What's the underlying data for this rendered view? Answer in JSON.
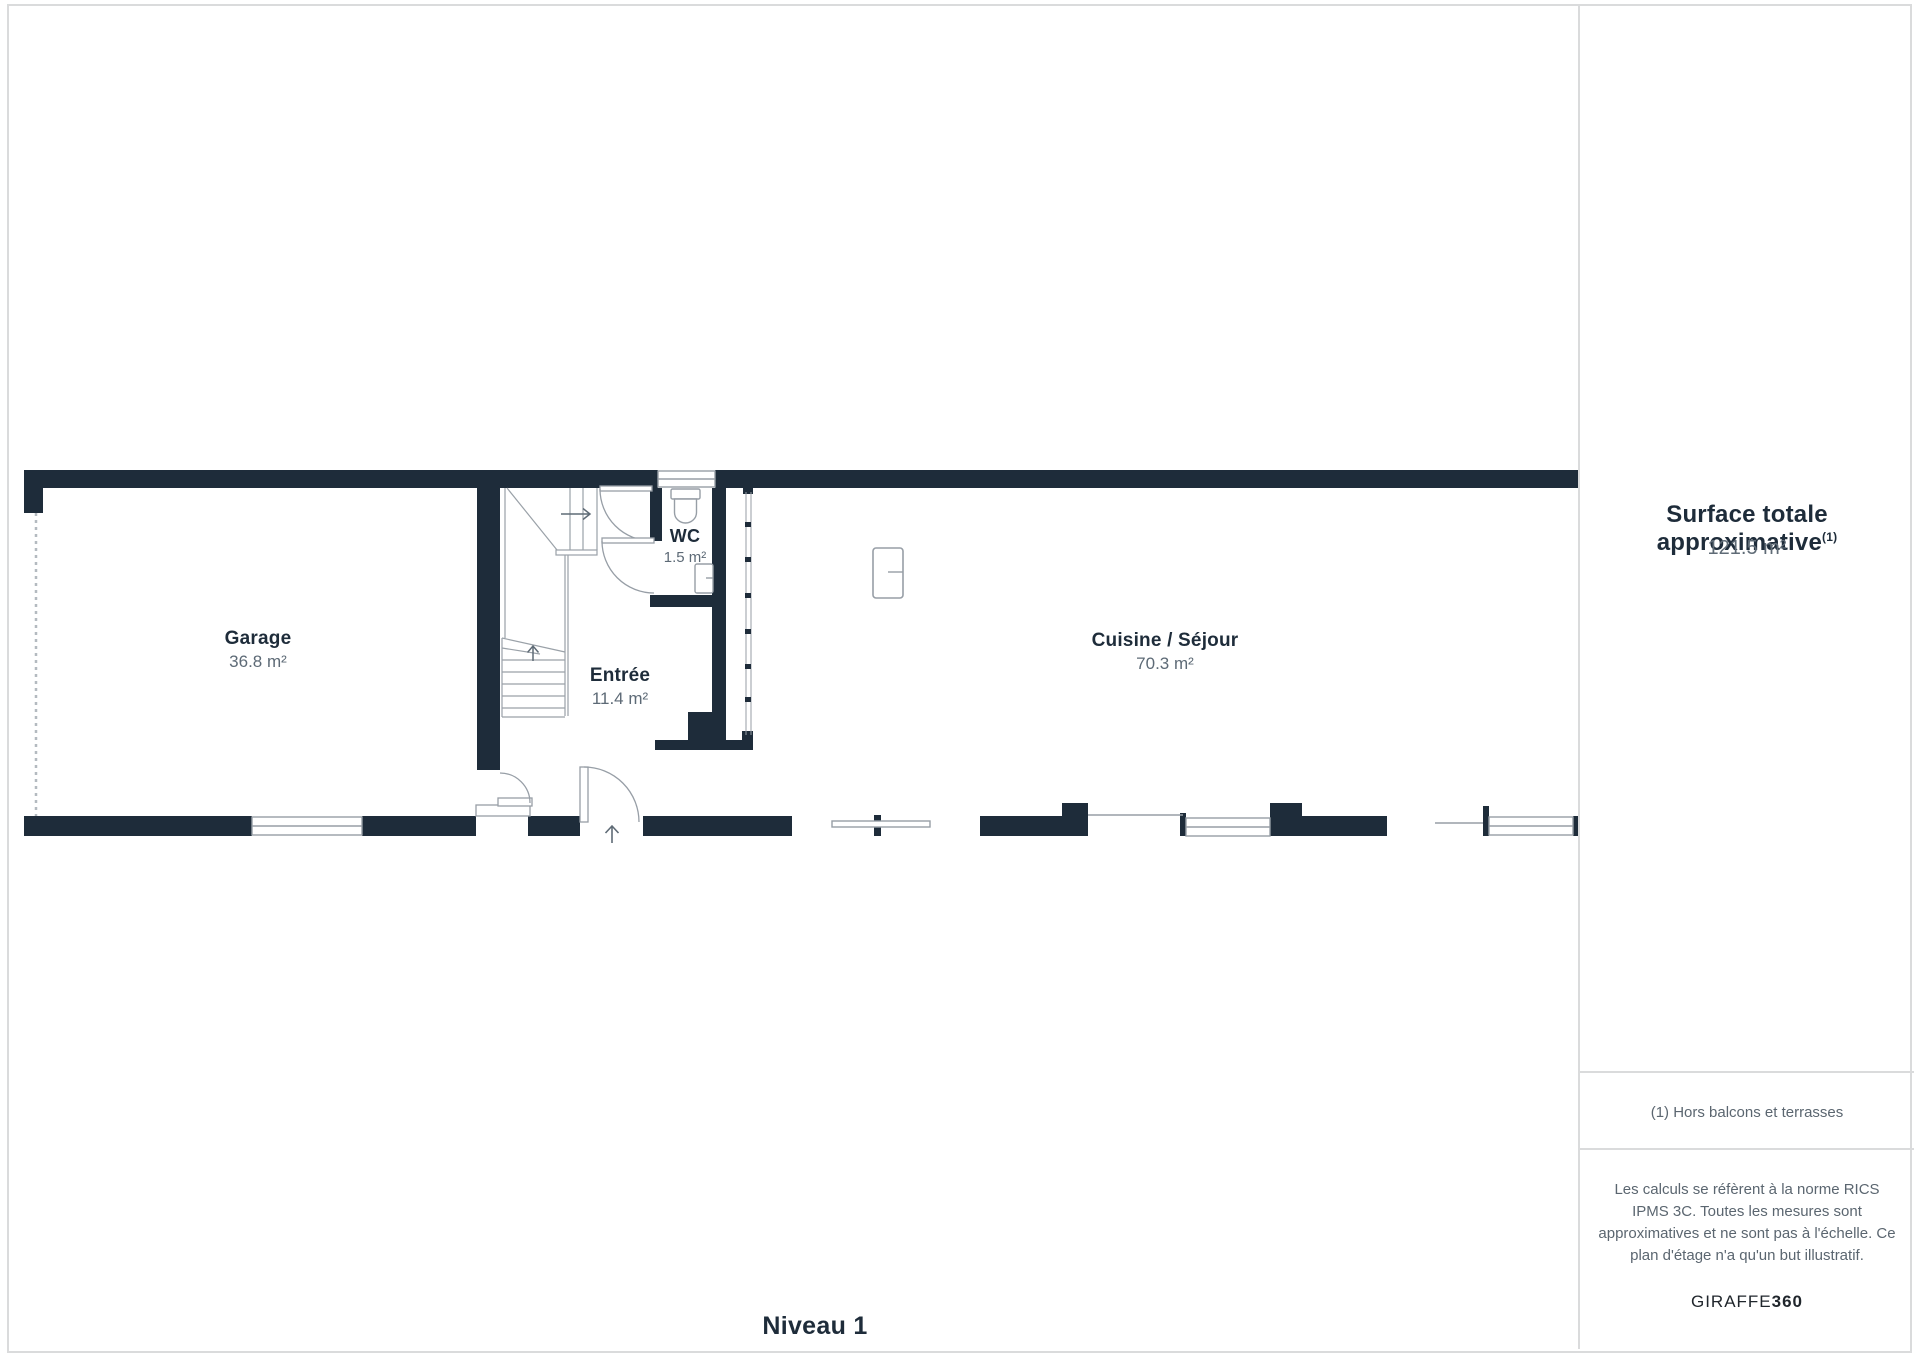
{
  "page": {
    "background": "#ffffff",
    "border_color": "#dadbdc"
  },
  "plan": {
    "level_label": "Niveau 1",
    "wall_color": "#1e2c3a",
    "line_color": "#979ea6",
    "rooms": [
      {
        "name": "Garage",
        "area": "36.8 m²"
      },
      {
        "name": "Entrée",
        "area": "11.4 m²"
      },
      {
        "name": "WC",
        "area": "1.5 m²"
      },
      {
        "name": "Cuisine / Séjour",
        "area": "70.3 m²"
      }
    ]
  },
  "sidebar": {
    "title": "Surface totale approximative",
    "title_superscript": "(1)",
    "total_area": "121.5 m²",
    "footnote": "(1) Hors balcons et terrasses",
    "disclaimer": "Les calculs se réfèrent à la norme RICS IPMS 3C. Toutes les mesures sont approximatives et ne sont pas à l'échelle. Ce plan d'étage n'a qu'un but illustratif.",
    "brand": {
      "name": "GIRAFFE",
      "suffix": "360"
    }
  }
}
